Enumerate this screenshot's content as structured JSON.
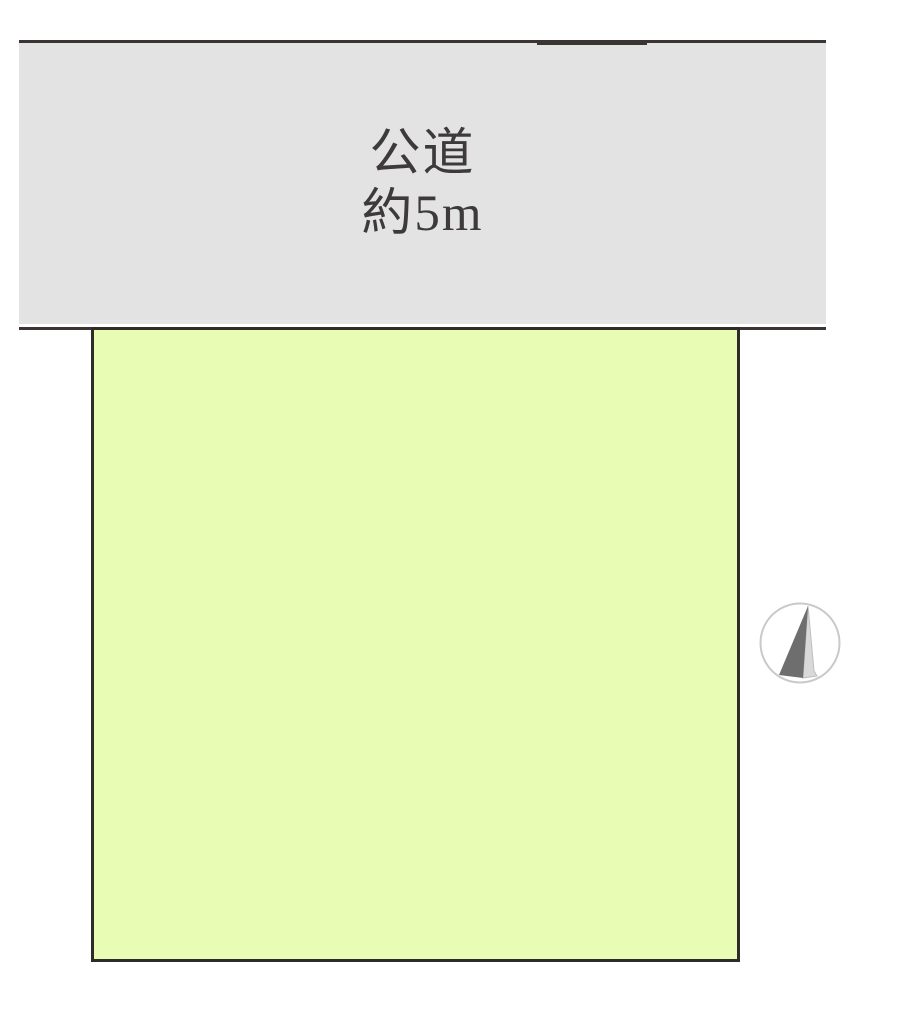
{
  "road": {
    "name": "公道",
    "width_label": "約5m"
  },
  "icons": {
    "north_arrow": "north-arrow-icon"
  },
  "colors": {
    "background": "#ffffff",
    "road_fill": "#e3e3e3",
    "parcel_fill": "#e9fcb4",
    "edge_line": "#3a3533",
    "parcel_border": "#2e2b28",
    "label_text": "#3e3a3b",
    "compass_dark": "#6e6e6e",
    "compass_light": "#d9d9d9",
    "compass_ring": "#c9c9c9"
  }
}
